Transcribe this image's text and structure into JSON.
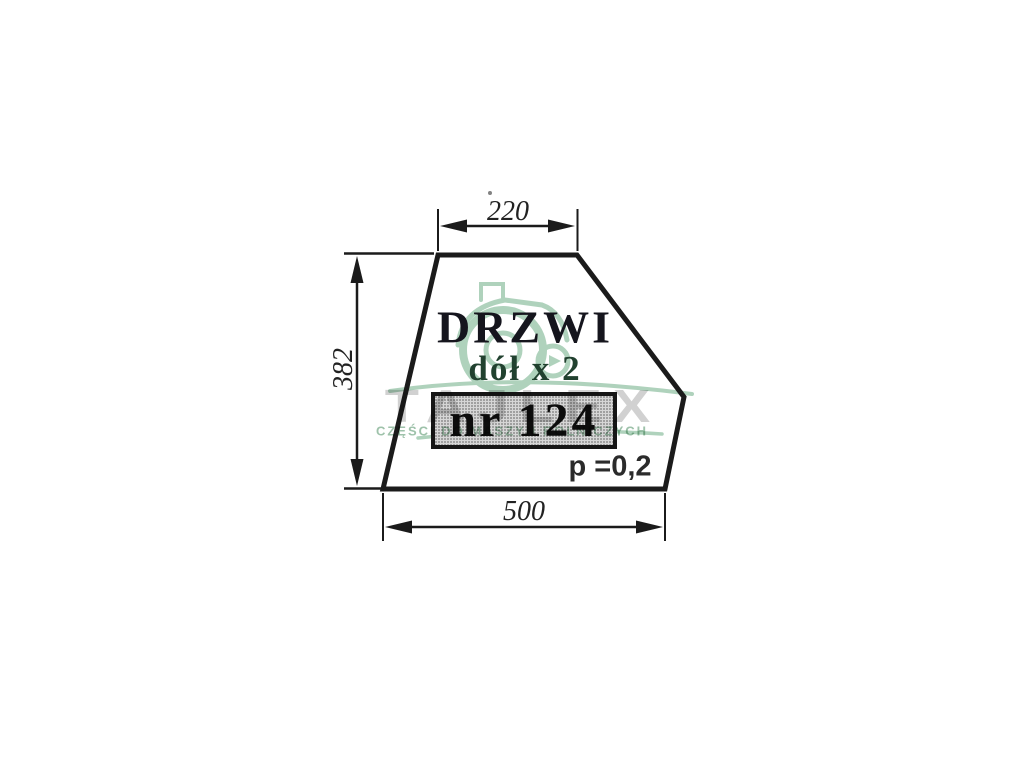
{
  "canvas": {
    "background": "#ffffff",
    "ink_color": "#1b1b1b"
  },
  "drawing": {
    "title": "DRZWI",
    "subtitle": "dół x 2",
    "part_label": "nr 124",
    "thickness_note": "p =0,2",
    "dim_top_width": "220",
    "dim_left_height": "382",
    "dim_bottom_width": "500"
  },
  "watermark": {
    "brand": "TAJLEX",
    "tagline": "CZĘŚCI DO MASZYN ROLNICZYCH",
    "logo": "tractor-icon",
    "brand_color": "#ababab",
    "green": "#6fae87"
  }
}
